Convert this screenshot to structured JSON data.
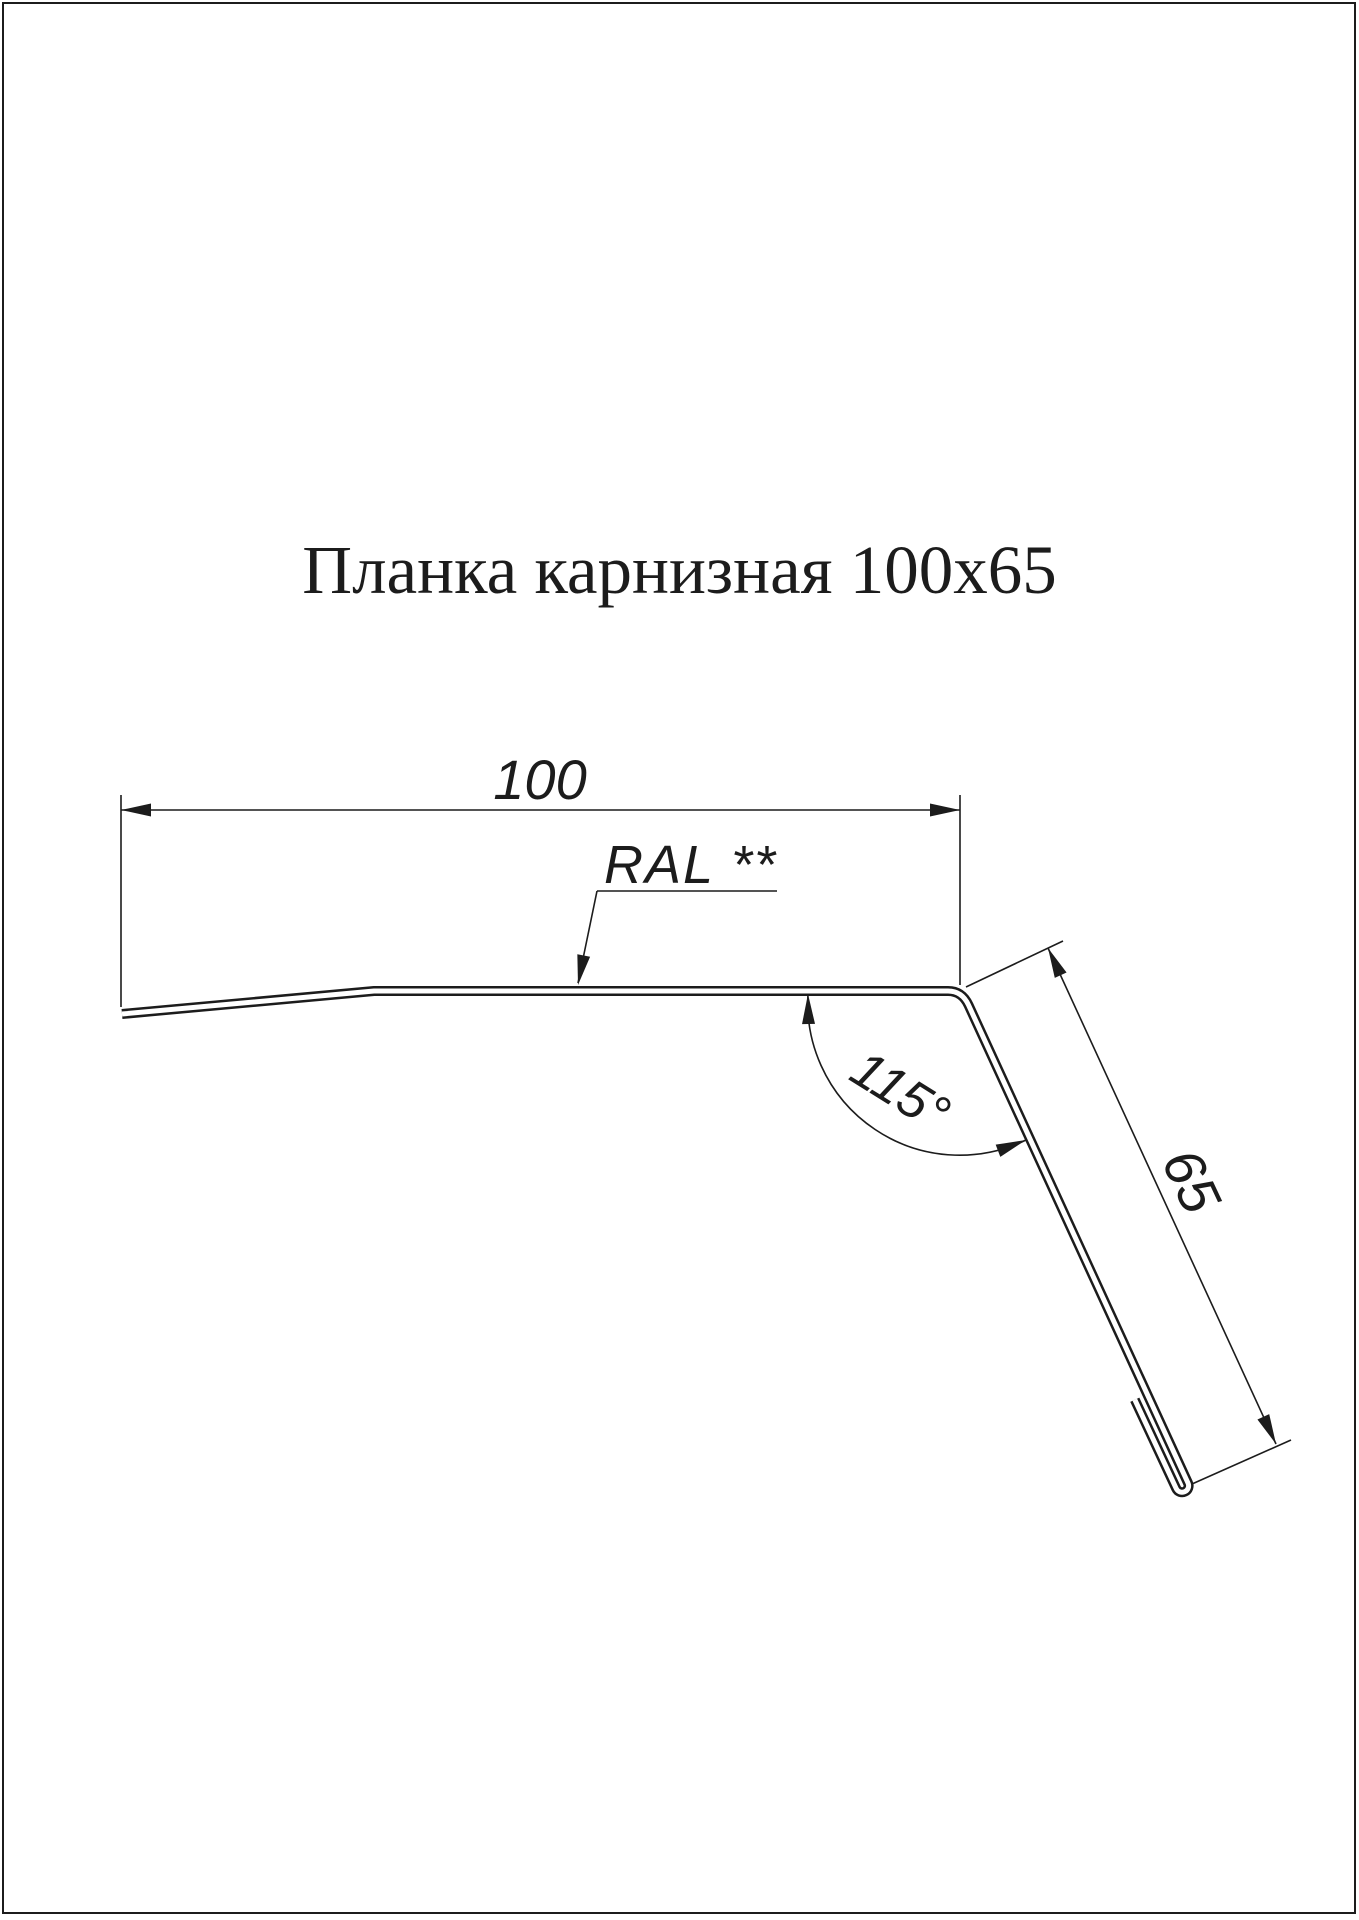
{
  "page": {
    "title": "Планка карнизная 100x65",
    "ink_color": "#1c1c1c",
    "paper_color": "#ffffff"
  },
  "drawing": {
    "labels": {
      "width": "100",
      "height": "65",
      "angle": "115°",
      "color_note": "RAL **"
    }
  }
}
